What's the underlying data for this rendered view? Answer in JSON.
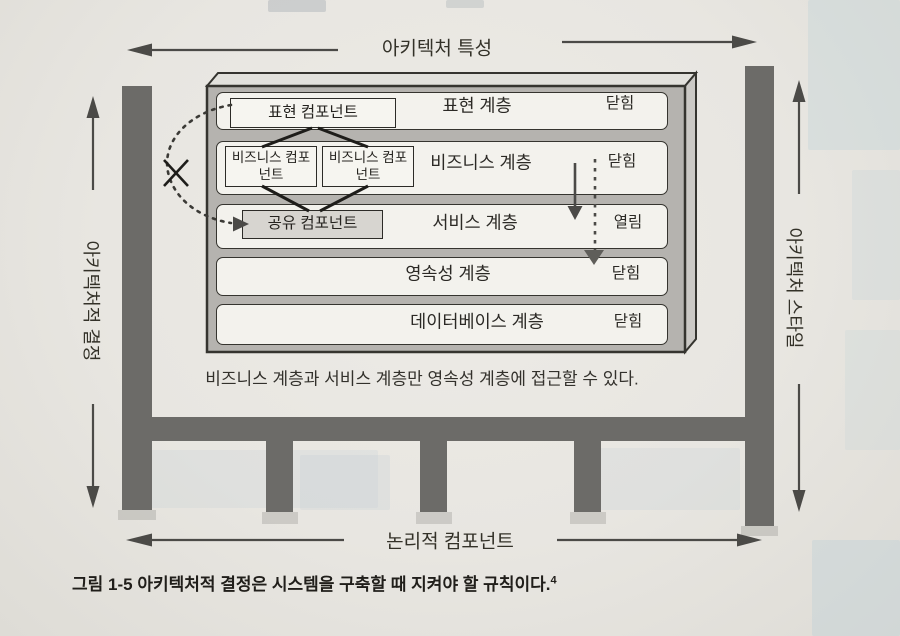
{
  "figure": {
    "top_axis": {
      "label": "아키텍처 특성"
    },
    "left_axis": {
      "label": "아키텍처적 결정"
    },
    "right_axis": {
      "label": "아키텍처 스타일"
    },
    "bottom_axis": {
      "label": "논리적 컴포넌트"
    },
    "layers": [
      {
        "name": "표현 계층",
        "state": "닫힘",
        "components": [
          "표현 컴포넌트"
        ]
      },
      {
        "name": "비즈니스 계층",
        "state": "닫힘",
        "components": [
          "비즈니스 컴포넌트",
          "비즈니스 컴포넌트"
        ]
      },
      {
        "name": "서비스 계층",
        "state": "열림",
        "components": [
          "공유 컴포넌트"
        ]
      },
      {
        "name": "영속성 계층",
        "state": "닫힘",
        "components": []
      },
      {
        "name": "데이터베이스 계층",
        "state": "닫힘",
        "components": []
      }
    ],
    "note": "비즈니스 계층과 서비스 계층만 영속성 계층에 접근할 수 있다.",
    "caption": {
      "label": "그림 1-5",
      "text": "아키텍처적 결정은 시스템을 구축할 때 지켜야 할 규칙이다.",
      "footnote": "4"
    }
  },
  "colors": {
    "paper": "#e8e6e1",
    "beam_gray": "#6c6b68",
    "box_face_gray": "#b5b3af",
    "row_bg": "#f3f2ed",
    "shared_component_bg": "#d7d5d0",
    "line_dark": "#1e1d1a"
  }
}
